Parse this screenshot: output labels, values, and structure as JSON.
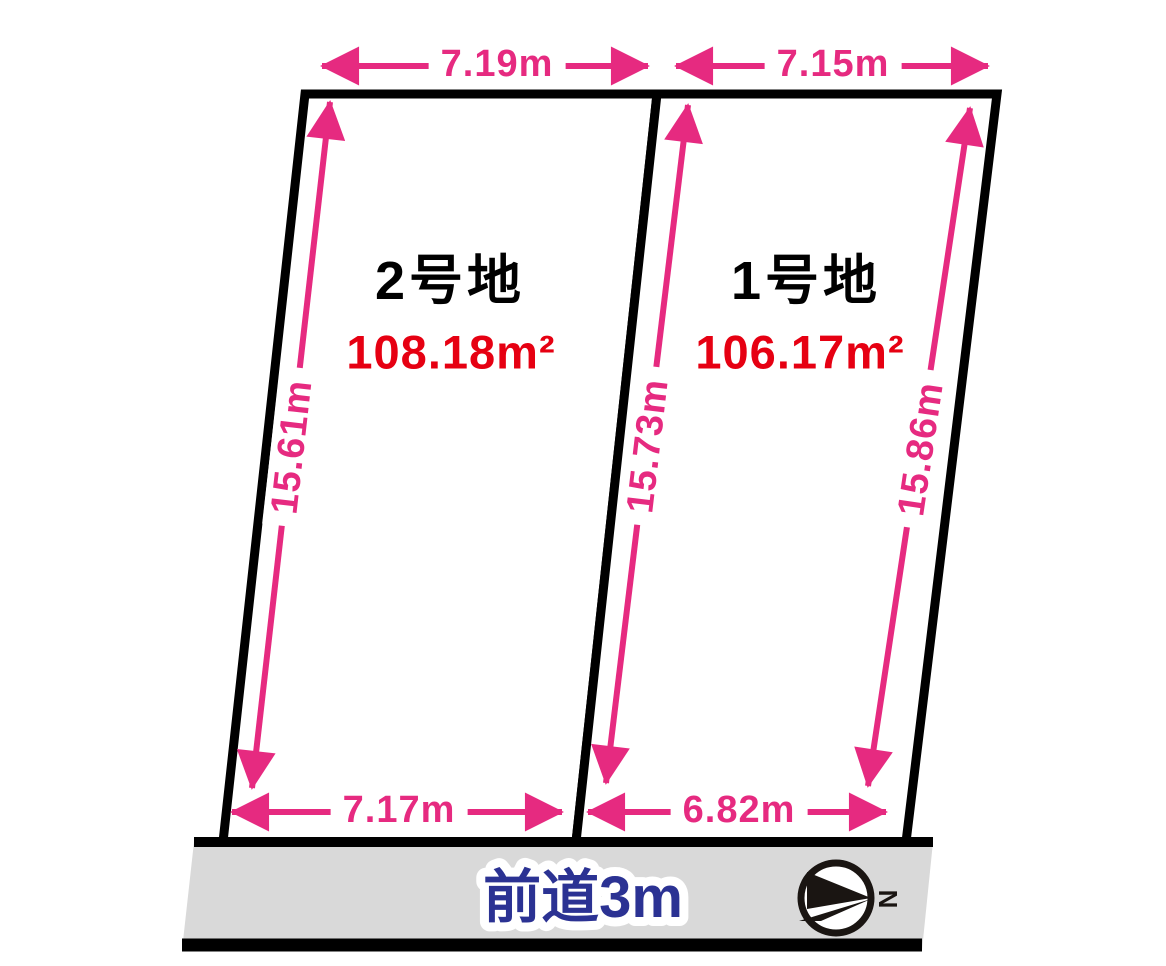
{
  "diagram_title": "land-subdivision-plan",
  "lots": [
    {
      "id": "lot-2",
      "name": "2号地",
      "area": "108.18m²",
      "dimensions": {
        "top": "7.19m",
        "bottom": "7.17m",
        "side": "15.61m"
      }
    },
    {
      "id": "lot-1",
      "name": "1号地",
      "area": "106.17m²",
      "dimensions": {
        "top": "7.15m",
        "bottom": "6.82m",
        "left": "15.73m",
        "right": "15.86m"
      }
    }
  ],
  "road": {
    "label": "前道3m"
  },
  "compass": {
    "north_label": "N"
  },
  "colors": {
    "dimension_pink": "#e62a80",
    "area_red": "#e60012",
    "road_text_blue": "#2b3293",
    "road_gray": "#d9d9d9",
    "outline_black": "#000000"
  }
}
